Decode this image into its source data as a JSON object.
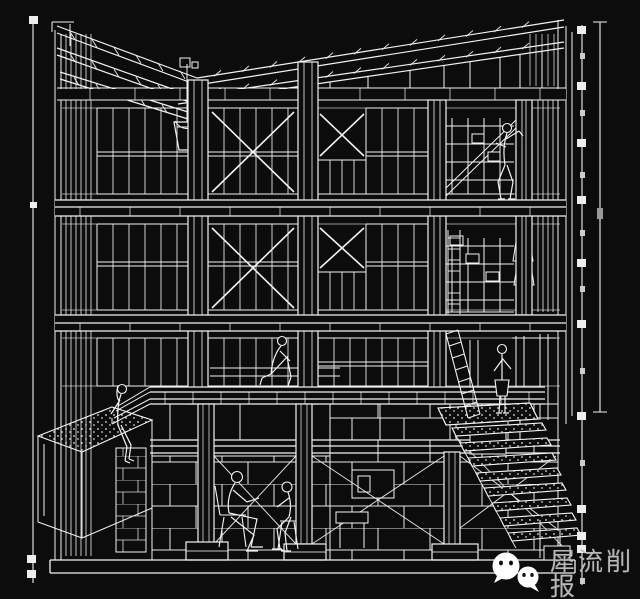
{
  "colors": {
    "background": "#0c0c0c",
    "line": "#f2f2f2",
    "tick": "#eeeeee",
    "watermark_text_color": "#b8b8b8"
  },
  "drawing": {
    "kind": "building-section-wireframe"
  },
  "watermark": {
    "icon": "wechat-bubbles-icon",
    "text": "犀流削报"
  }
}
